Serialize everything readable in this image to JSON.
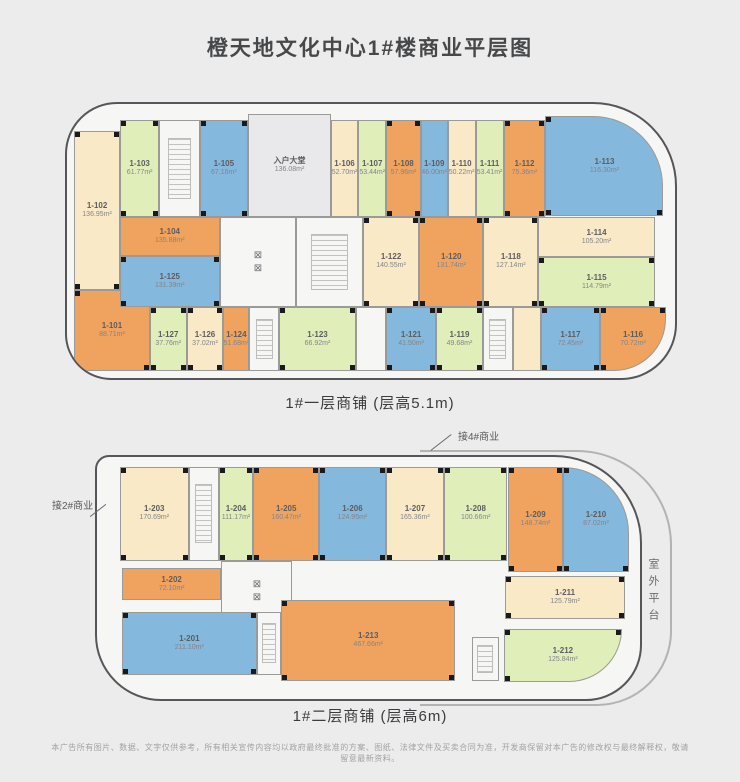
{
  "page": {
    "title": "橙天地文化中心1#楼商业平层图",
    "disclaimer": "本广告所有图片、数据、文字仅供参考，所有相关宣传内容均以政府最终批准的方案、图纸、法律文件及买卖合同为准，开发商保留对本广告的修改权与最终解释权，敬请留意最新资料。"
  },
  "colors": {
    "orange": "#f0a35f",
    "cream": "#fae9c6",
    "green": "#e0efba",
    "blue": "#85b8dd",
    "lobby": "#e9e9ec",
    "white": "#f6f6f4"
  },
  "floor1": {
    "caption": "1#一层商铺 (层高5.1m)",
    "units": [
      {
        "id": "1-102",
        "area": "136.95m²",
        "color": "cream",
        "x": 1.2,
        "y": 10,
        "w": 7.5,
        "h": 58
      },
      {
        "id": "1-101",
        "area": "88.71m²",
        "color": "orange",
        "x": 1.2,
        "y": 68,
        "w": 12.4,
        "h": 29.5
      },
      {
        "id": "1-103",
        "area": "61.77m²",
        "color": "green",
        "x": 8.7,
        "y": 6,
        "w": 6.5,
        "h": 35.2
      },
      {
        "deco": "stair",
        "color": "white",
        "x": 15.2,
        "y": 6,
        "w": 6.6,
        "h": 35.2
      },
      {
        "id": "1-105",
        "area": "67.16m²",
        "color": "blue",
        "x": 21.8,
        "y": 6,
        "w": 8,
        "h": 35.2
      },
      {
        "name": "入户大堂",
        "area": "136.08m²",
        "color": "lobby",
        "x": 29.8,
        "y": 3.5,
        "w": 13.6,
        "h": 37.7
      },
      {
        "id": "1-106",
        "area": "52.70m²",
        "color": "cream",
        "x": 43.4,
        "y": 6,
        "w": 4.5,
        "h": 35.2
      },
      {
        "id": "1-107",
        "area": "53.44m²",
        "color": "green",
        "x": 47.9,
        "y": 6,
        "w": 4.6,
        "h": 35.2
      },
      {
        "id": "1-108",
        "area": "57.96m²",
        "color": "orange",
        "x": 52.5,
        "y": 6,
        "w": 5.7,
        "h": 35.2
      },
      {
        "id": "1-109",
        "area": "46.00m²",
        "color": "blue",
        "x": 58.2,
        "y": 6,
        "w": 4.4,
        "h": 35.2
      },
      {
        "id": "1-110",
        "area": "50.22m²",
        "color": "cream",
        "x": 62.6,
        "y": 6,
        "w": 4.6,
        "h": 35.2
      },
      {
        "id": "1-111",
        "area": "53.41m²",
        "color": "green",
        "x": 67.2,
        "y": 6,
        "w": 4.6,
        "h": 35.2
      },
      {
        "id": "1-112",
        "area": "75.36m²",
        "color": "orange",
        "x": 71.8,
        "y": 6,
        "w": 6.9,
        "h": 35.2
      },
      {
        "id": "1-113",
        "area": "116.30m²",
        "color": "blue",
        "x": 78.7,
        "y": 4.5,
        "w": 19.4,
        "h": 36.5,
        "r": "0 70px 0 0"
      },
      {
        "id": "1-104",
        "area": "135.88m²",
        "color": "orange",
        "x": 8.7,
        "y": 41.2,
        "w": 16.4,
        "h": 14.3
      },
      {
        "id": "1-125",
        "area": "131.39m²",
        "color": "blue",
        "x": 8.7,
        "y": 55.5,
        "w": 16.4,
        "h": 18.5
      },
      {
        "deco": "elev",
        "color": "white",
        "x": 25.1,
        "y": 41.2,
        "w": 12.6,
        "h": 32.8
      },
      {
        "deco": "stair",
        "color": "white",
        "x": 37.7,
        "y": 41.2,
        "w": 11,
        "h": 32.8
      },
      {
        "id": "1-122",
        "area": "140.55m²",
        "color": "cream",
        "x": 48.7,
        "y": 41.2,
        "w": 9.2,
        "h": 32.8
      },
      {
        "id": "1-120",
        "area": "131.74m²",
        "color": "orange",
        "x": 57.9,
        "y": 41.2,
        "w": 10.6,
        "h": 32.8
      },
      {
        "id": "1-118",
        "area": "127.14m²",
        "color": "cream",
        "x": 68.5,
        "y": 41.2,
        "w": 9,
        "h": 32.8
      },
      {
        "id": "1-114",
        "area": "105.20m²",
        "color": "cream",
        "x": 77.5,
        "y": 41.2,
        "w": 19.2,
        "h": 14.8
      },
      {
        "id": "1-115",
        "area": "114.79m²",
        "color": "green",
        "x": 77.5,
        "y": 56,
        "w": 19.2,
        "h": 18
      },
      {
        "id": "1-127",
        "area": "37.76m²",
        "color": "green",
        "x": 13.6,
        "y": 74,
        "w": 6.1,
        "h": 23.5
      },
      {
        "id": "1-126",
        "area": "37.02m²",
        "color": "cream",
        "x": 19.7,
        "y": 74,
        "w": 6,
        "h": 23.5
      },
      {
        "id": "1-124",
        "area": "51.68m²",
        "color": "orange",
        "x": 25.7,
        "y": 74,
        "w": 4.3,
        "h": 23.5
      },
      {
        "deco": "stair",
        "color": "white",
        "x": 30,
        "y": 74,
        "w": 4.9,
        "h": 23.5
      },
      {
        "id": "1-123",
        "area": "66.92m²",
        "color": "green",
        "x": 34.9,
        "y": 74,
        "w": 12.6,
        "h": 23.5
      },
      {
        "color": "white",
        "x": 47.5,
        "y": 74,
        "w": 5,
        "h": 23.5
      },
      {
        "id": "1-121",
        "area": "41.50m²",
        "color": "blue",
        "x": 52.5,
        "y": 74,
        "w": 8.2,
        "h": 23.5
      },
      {
        "id": "1-119",
        "area": "49.68m²",
        "color": "green",
        "x": 60.7,
        "y": 74,
        "w": 7.7,
        "h": 23.5
      },
      {
        "deco": "stair",
        "color": "white",
        "x": 68.4,
        "y": 74,
        "w": 4.9,
        "h": 23.5
      },
      {
        "color": "cream",
        "x": 73.3,
        "y": 74,
        "w": 4.6,
        "h": 23.5
      },
      {
        "id": "1-117",
        "area": "72.45m²",
        "color": "blue",
        "x": 77.9,
        "y": 74,
        "w": 9.8,
        "h": 23.5
      },
      {
        "id": "1-116",
        "area": "70.72m²",
        "color": "orange",
        "x": 87.7,
        "y": 74,
        "w": 10.8,
        "h": 23.5,
        "r": "0 0 52px 0"
      }
    ]
  },
  "floor2": {
    "caption": "1#二层商铺 (层高6m)",
    "connect_top": "接4#商业",
    "connect_left": "接2#商业",
    "terrace": "室外平台",
    "units": [
      {
        "id": "1-203",
        "area": "170.69m²",
        "color": "cream",
        "x": 4.2,
        "y": 4,
        "w": 12.7,
        "h": 39
      },
      {
        "deco": "stair",
        "color": "white",
        "x": 16.9,
        "y": 4,
        "w": 5.5,
        "h": 39
      },
      {
        "id": "1-204",
        "area": "111.17m²",
        "color": "green",
        "x": 22.4,
        "y": 4,
        "w": 6.4,
        "h": 39
      },
      {
        "id": "1-205",
        "area": "160.47m²",
        "color": "orange",
        "x": 28.8,
        "y": 4,
        "w": 12.1,
        "h": 39
      },
      {
        "id": "1-206",
        "area": "124.95m²",
        "color": "blue",
        "x": 40.9,
        "y": 4,
        "w": 12.3,
        "h": 39
      },
      {
        "id": "1-207",
        "area": "165.36m²",
        "color": "cream",
        "x": 53.2,
        "y": 4,
        "w": 10.7,
        "h": 39
      },
      {
        "id": "1-208",
        "area": "100.66m²",
        "color": "green",
        "x": 63.9,
        "y": 4,
        "w": 11.7,
        "h": 39
      },
      {
        "id": "1-209",
        "area": "148.74m²",
        "color": "orange",
        "x": 75.6,
        "y": 4,
        "w": 10.3,
        "h": 43.5
      },
      {
        "id": "1-210",
        "area": "87.02m²",
        "color": "blue",
        "x": 85.9,
        "y": 4,
        "w": 12,
        "h": 43.5,
        "r": "0 88px 0 0"
      },
      {
        "id": "1-202",
        "area": "72.10m²",
        "color": "orange",
        "x": 4.6,
        "y": 46,
        "w": 18.3,
        "h": 13
      },
      {
        "deco": "elev",
        "color": "white",
        "x": 22.9,
        "y": 43,
        "w": 13.1,
        "h": 24.5
      },
      {
        "id": "1-201",
        "area": "211.10m²",
        "color": "blue",
        "x": 4.6,
        "y": 64,
        "w": 24.8,
        "h": 26
      },
      {
        "deco": "stair",
        "color": "white",
        "x": 29.4,
        "y": 64,
        "w": 4.5,
        "h": 26
      },
      {
        "id": "1-213",
        "area": "467.66m²",
        "color": "orange",
        "x": 33.9,
        "y": 59,
        "w": 32.1,
        "h": 33.5
      },
      {
        "id": "1-211",
        "area": "125.79m²",
        "color": "cream",
        "x": 75.2,
        "y": 49,
        "w": 22,
        "h": 18
      },
      {
        "deco": "stair",
        "color": "white",
        "x": 69,
        "y": 74.5,
        "w": 5,
        "h": 18
      },
      {
        "id": "1-212",
        "area": "125.84m²",
        "color": "green",
        "x": 74.9,
        "y": 71,
        "w": 21.8,
        "h": 22,
        "r": "0 0 55px 0"
      }
    ]
  }
}
